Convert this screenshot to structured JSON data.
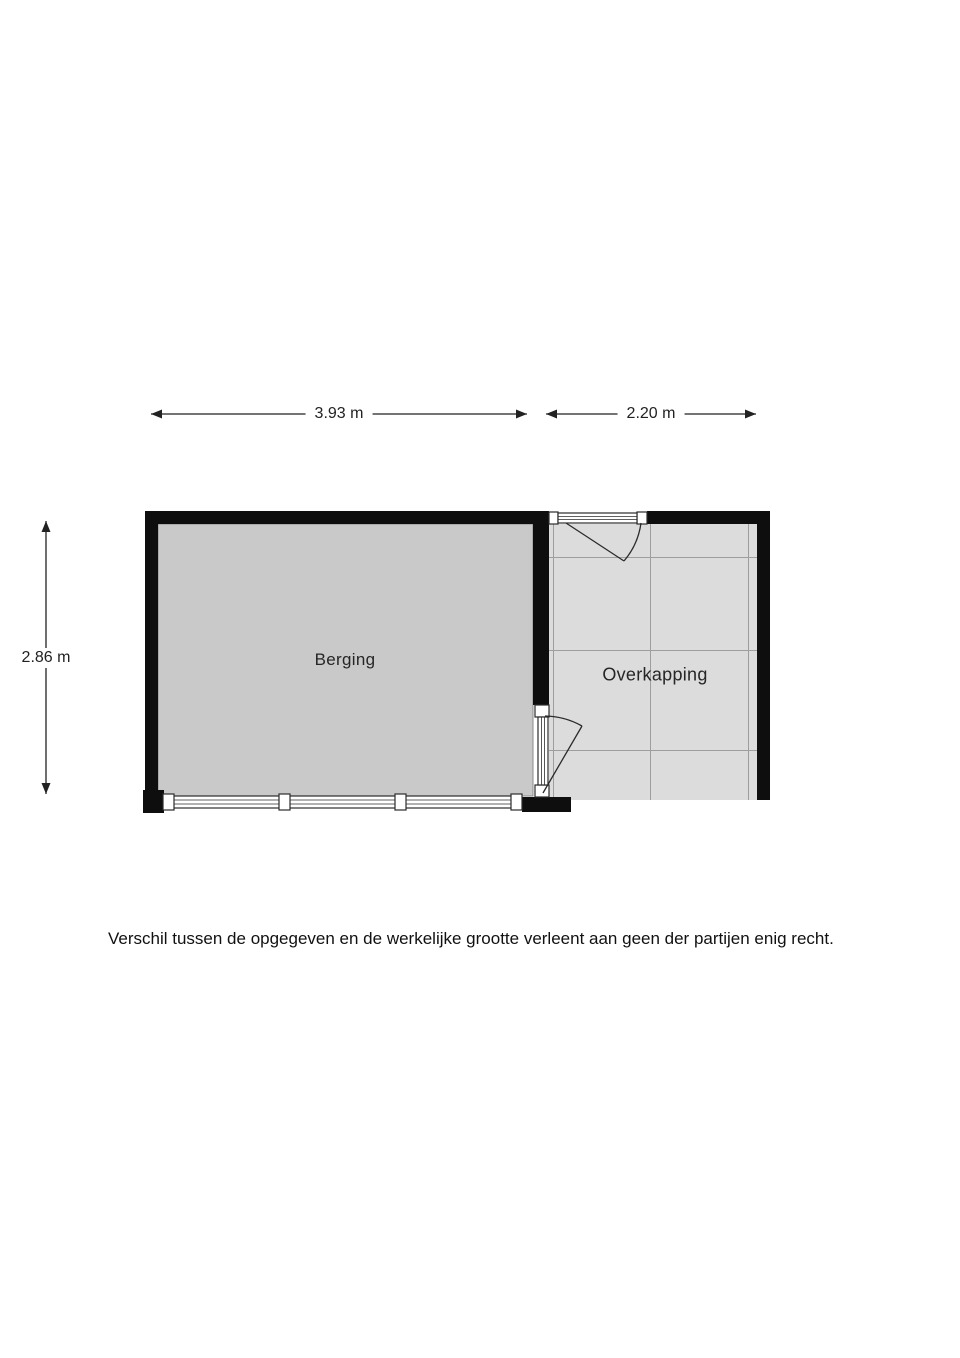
{
  "floor_plan": {
    "rooms": {
      "berging": {
        "name": "Berging"
      },
      "overkapping": {
        "name": "Overkapping"
      }
    },
    "dimensions": {
      "berging_width": "3.93 m",
      "overkapping_width": "2.20 m",
      "plan_height": "2.86 m"
    },
    "features": [
      "window-strip-bottom-berging",
      "door-top-overkapping",
      "door-between-berging-and-overkapping",
      "tile-grid-overkapping"
    ]
  },
  "footer": {
    "disclaimer": "Verschil tussen de opgegeven en de werkelijke grootte verleent aan geen der partijen enig recht."
  },
  "colors": {
    "background": "#ffffff",
    "wall": "#0e0e0e",
    "berging_floor": "#c9c9c9",
    "overkapping_floor": "#dcdcdc",
    "tile_grid_line": "#9e9e9e",
    "dimension_line": "#222222",
    "door_line": "#2b2b2b",
    "label_text": "#222222"
  }
}
